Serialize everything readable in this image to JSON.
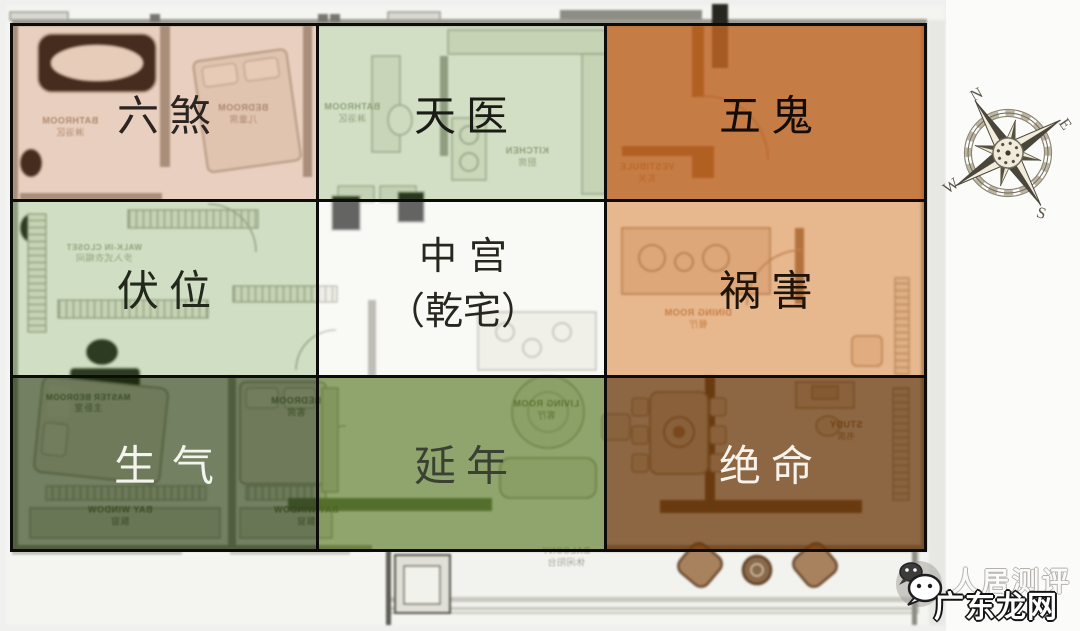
{
  "page": {
    "background": "#f0f0ee",
    "title": "八宅风水九宫格户型图"
  },
  "grid": {
    "cells": [
      {
        "id": "liu-sha",
        "label": "六煞",
        "overlay": "rgba(206,130,88,0.34)",
        "text_color": "#2b2420"
      },
      {
        "id": "tian-yi",
        "label": "天医",
        "overlay": "rgba(132,172,100,0.32)",
        "text_color": "#1c1c16"
      },
      {
        "id": "wu-gui",
        "label": "五鬼",
        "overlay": "rgba(188,100,34,0.84)",
        "text_color": "#140c06"
      },
      {
        "id": "fu-wei",
        "label": "伏位",
        "overlay": "rgba(132,172,100,0.34)",
        "text_color": "#23281c"
      },
      {
        "id": "zhong-gong",
        "label": "中宫",
        "label_line2": "（乾宅）",
        "overlay": "rgba(250,250,248,0.4)",
        "text_color": "#27271f"
      },
      {
        "id": "huo-hai",
        "label": "祸害",
        "overlay": "rgba(214,122,48,0.52)",
        "text_color": "#1e1409"
      },
      {
        "id": "sheng-qi",
        "label": "生气",
        "overlay": "rgba(46,66,22,0.66)",
        "text_color": "#f4f4ee"
      },
      {
        "id": "yan-nian",
        "label": "延年",
        "overlay": "rgba(80,115,28,0.62)",
        "text_color": "#3a4133"
      },
      {
        "id": "jue-ming",
        "label": "绝命",
        "overlay": "rgba(105,55,8,0.75)",
        "text_color": "#f6f2ec"
      }
    ]
  },
  "compass": {
    "north": "N",
    "east": "E",
    "south": "S",
    "west": "W",
    "rotation_deg": -32
  },
  "watermark": {
    "line1": "人居测评",
    "line2": "广东龙网",
    "icon": "wechat-icon"
  },
  "floorplan": {
    "room_labels": [
      {
        "en": "BATHROOM",
        "cn": "淋浴区"
      },
      {
        "en": "BEDROOM",
        "cn": "儿童房"
      },
      {
        "en": "BATHROOM",
        "cn": "淋浴区"
      },
      {
        "en": "KITCHEN",
        "cn": "厨房"
      },
      {
        "en": "VESTIBULE",
        "cn": "玄关"
      },
      {
        "en": "WALK-IN CLOSET",
        "cn": "步入式衣帽间"
      },
      {
        "en": "DINING ROOM",
        "cn": "餐厅"
      },
      {
        "en": "MASTER BEDROOM",
        "cn": "主卧室"
      },
      {
        "en": "BEDROOM",
        "cn": "客房"
      },
      {
        "en": "BAY WINDOW",
        "cn": "飘窗"
      },
      {
        "en": "BAY WINDOW",
        "cn": "飘窗"
      },
      {
        "en": "LIVING ROOM",
        "cn": "客厅"
      },
      {
        "en": "STUDY",
        "cn": "书房"
      },
      {
        "en": "BALCONY",
        "cn": "休闲阳台"
      }
    ]
  }
}
